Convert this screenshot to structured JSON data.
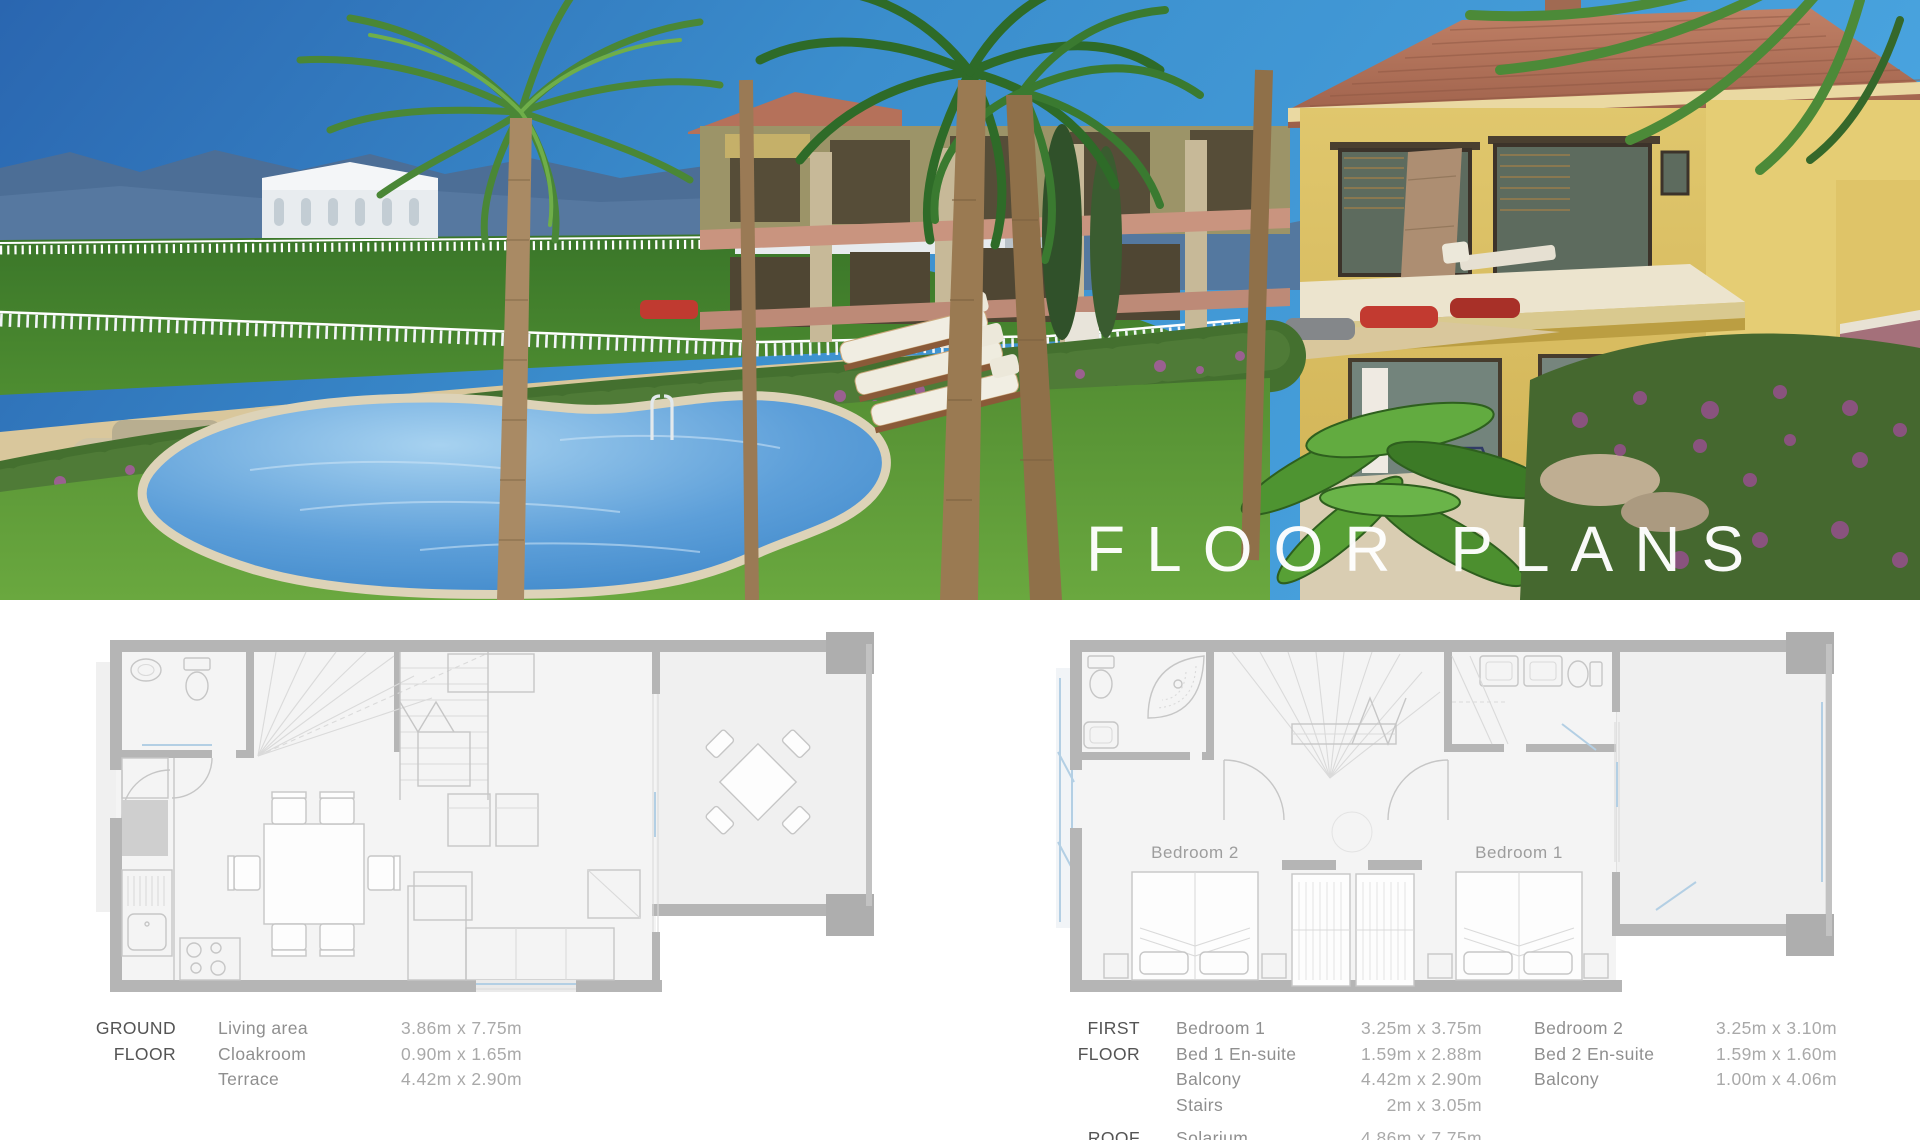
{
  "hero": {
    "title": "FLOOR PLANS",
    "colors": {
      "sky": "#3f94d2",
      "pool": "#4e97d8",
      "villa_wall": "#dcc266",
      "roof": "#b0735a",
      "lawn": "#5c9638",
      "sea": "#5588b4"
    }
  },
  "plans": {
    "ground": {
      "name_line1": "GROUND",
      "name_line2": "FLOOR",
      "rows": [
        {
          "label": "Living area",
          "size": "3.86m x 7.75m"
        },
        {
          "label": "Cloakroom",
          "size": "0.90m x 1.65m"
        },
        {
          "label": "Terrace",
          "size": "4.42m x 2.90m"
        }
      ]
    },
    "first": {
      "name_line1": "FIRST",
      "name_line2": "FLOOR",
      "col1": [
        {
          "label": "Bedroom 1",
          "size": "3.25m x 3.75m"
        },
        {
          "label": "Bed 1 En-suite",
          "size": "1.59m x 2.88m"
        },
        {
          "label": "Balcony",
          "size": "4.42m x 2.90m"
        },
        {
          "label": "Stairs",
          "size": "2m x 3.05m"
        }
      ],
      "col2": [
        {
          "label": "Bedroom 2",
          "size": "3.25m x 3.10m"
        },
        {
          "label": "Bed 2 En-suite",
          "size": "1.59m x 1.60m"
        },
        {
          "label": "Balcony",
          "size": "1.00m x 4.06m"
        }
      ],
      "bedroom1_label": "Bedroom 1",
      "bedroom2_label": "Bedroom 2"
    },
    "roof": {
      "name": "ROOF",
      "row": {
        "label": "Solarium",
        "size": "4.86m x 7.75m"
      }
    }
  }
}
